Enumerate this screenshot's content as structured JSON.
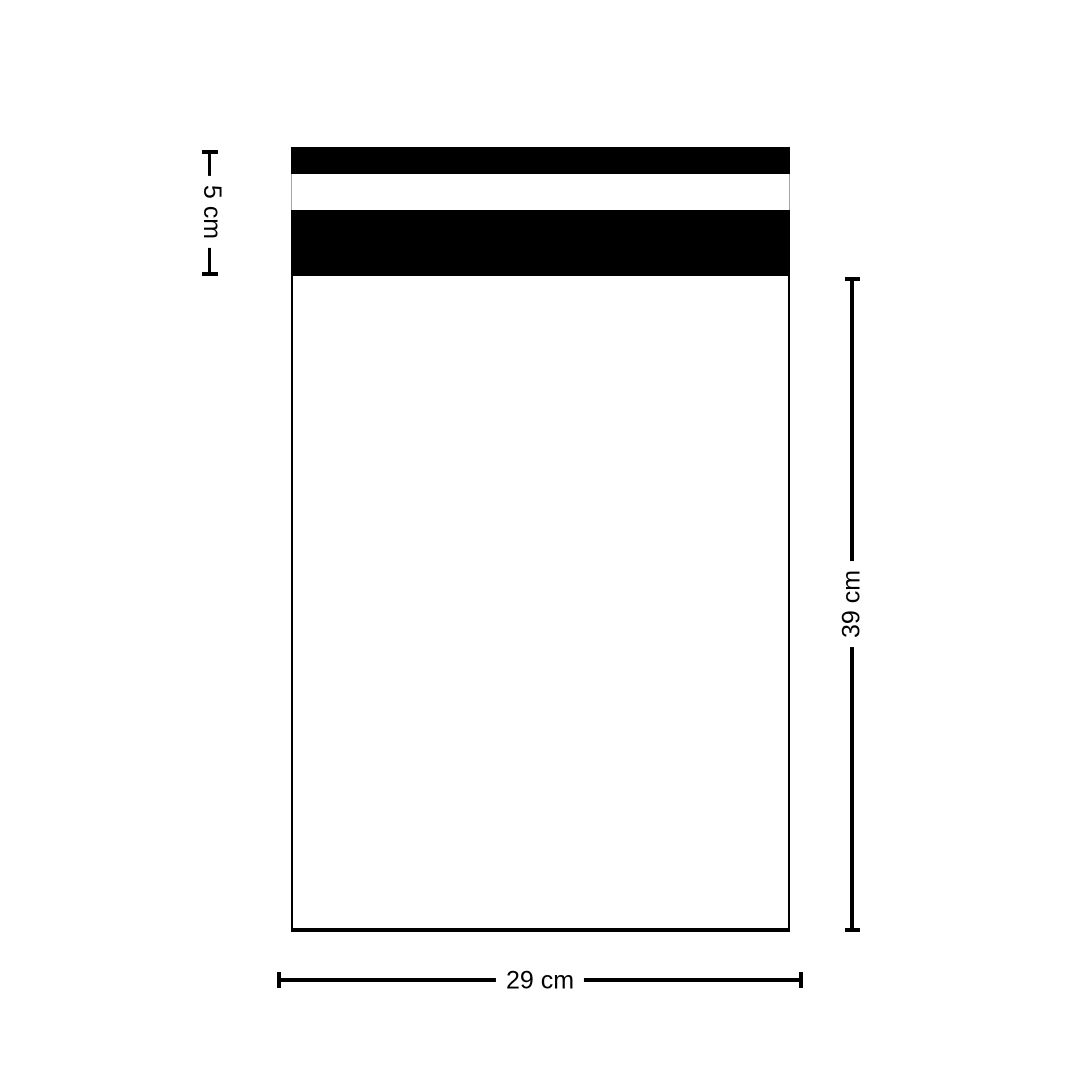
{
  "colors": {
    "ink": "#000000",
    "bag-fill": "#ffffff",
    "gap-border": "#a6a6a6",
    "background": "#ffffff"
  },
  "diagram": {
    "dimensions": {
      "flap": {
        "label": "5 cm"
      },
      "height": {
        "label": "39 cm"
      },
      "width": {
        "label": "29 cm"
      }
    }
  }
}
